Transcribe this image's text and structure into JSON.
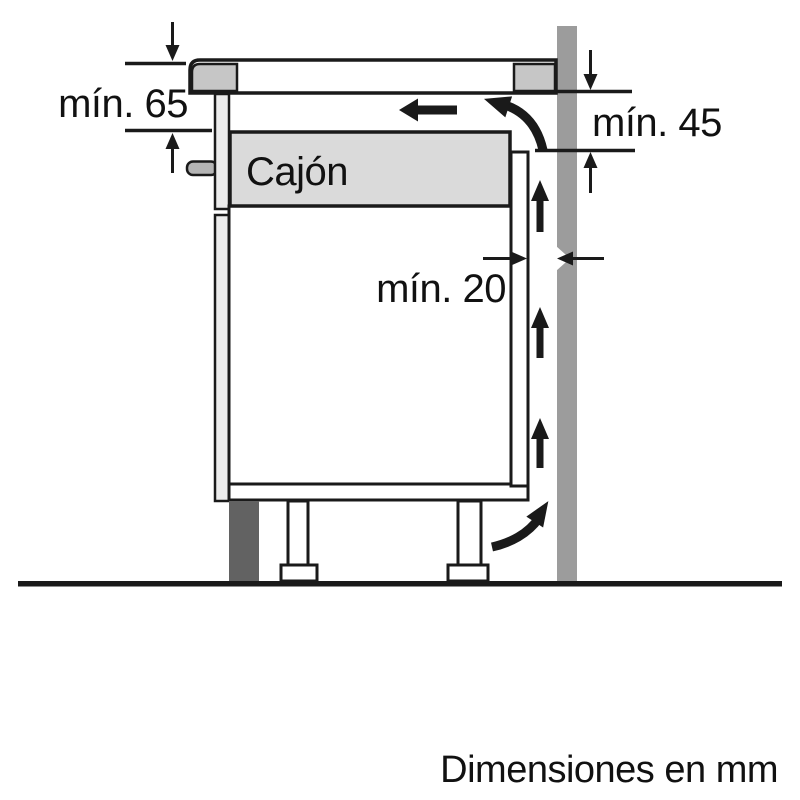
{
  "labels": {
    "min65": "mín. 65",
    "min45": "mín. 45",
    "min20": "mín. 20",
    "drawer": "Cajón",
    "units": "Dimensiones en mm"
  },
  "colors": {
    "line": "#1a1a1a",
    "wall": "#9c9c9c",
    "plinth": "#626262",
    "hob_cap": "#c6c6c6",
    "drawer_fill": "#dadada",
    "front_panel": "#ececec",
    "handle": "#b5b5b5",
    "background": "#ffffff"
  }
}
